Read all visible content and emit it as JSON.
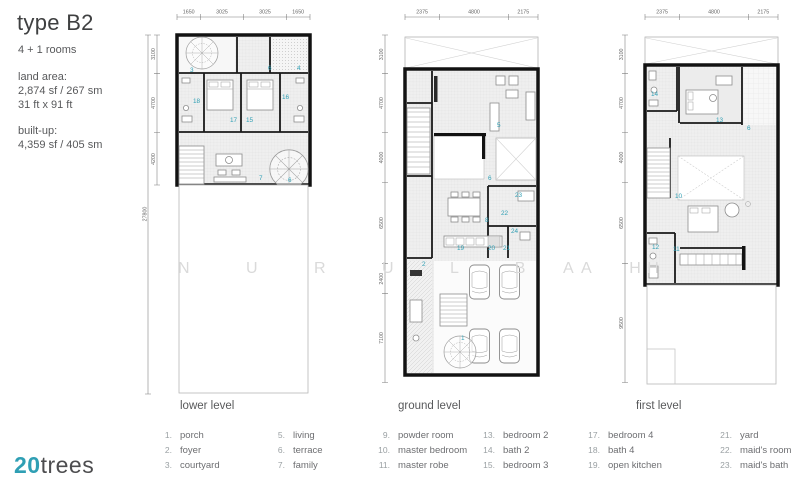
{
  "header": {
    "title": "type B2",
    "rooms": "4 + 1 rooms",
    "land_area_label": "land area:",
    "land_area_value": "2,874 sf / 267 sm",
    "land_area_dims": "31 ft x 91 ft",
    "built_up_label": "built-up:",
    "built_up_value": "4,359 sf / 405 sm"
  },
  "logo": {
    "number": "20",
    "word": "trees"
  },
  "watermark": {
    "part1": "N U R U L B A H",
    "part2": "A H"
  },
  "colors": {
    "accent_teal": "#2f9fb4",
    "wall_black": "#121212",
    "text_dark": "#3f4041",
    "text_gray": "#58595b"
  },
  "plans": [
    {
      "name": "lower level",
      "top_dims": [
        "1650",
        "3025",
        "3025",
        "1650"
      ],
      "left_dims": [
        "3100",
        "4700",
        "4200"
      ],
      "total_dim": "27800",
      "room_labels": [
        "3",
        "6",
        "4",
        "18",
        "16",
        "17",
        "15",
        "7",
        "6"
      ]
    },
    {
      "name": "ground level",
      "top_dims": [
        "2375",
        "4800",
        "2175"
      ],
      "left_dims": [
        "3100",
        "4700",
        "4000",
        "6500",
        "2400",
        "7100"
      ],
      "room_labels": [
        "5",
        "6",
        "23",
        "22",
        "8",
        "24",
        "19",
        "20",
        "21",
        "2",
        "1"
      ]
    },
    {
      "name": "first level",
      "top_dims": [
        "2375",
        "4800",
        "2175"
      ],
      "left_dims": [
        "3100",
        "4700",
        "4000",
        "6500",
        "9500"
      ],
      "room_labels": [
        "14",
        "13",
        "6",
        "10",
        "12",
        "11"
      ]
    }
  ],
  "legends": [
    {
      "title": "lower level",
      "col1": [
        {
          "num": "1.",
          "label": "porch"
        },
        {
          "num": "2.",
          "label": "foyer"
        },
        {
          "num": "3.",
          "label": "courtyard"
        }
      ],
      "col2": [
        {
          "num": "5.",
          "label": "living"
        },
        {
          "num": "6.",
          "label": "terrace"
        },
        {
          "num": "7.",
          "label": "family"
        }
      ]
    },
    {
      "title": "ground level",
      "col1": [
        {
          "num": "9.",
          "label": "powder room"
        },
        {
          "num": "10.",
          "label": "master bedroom"
        },
        {
          "num": "11.",
          "label": "master robe"
        }
      ],
      "col2": [
        {
          "num": "13.",
          "label": "bedroom 2"
        },
        {
          "num": "14.",
          "label": "bath 2"
        },
        {
          "num": "15.",
          "label": "bedroom 3"
        }
      ]
    },
    {
      "title": "first level",
      "col1": [
        {
          "num": "17.",
          "label": "bedroom 4"
        },
        {
          "num": "18.",
          "label": "bath 4"
        },
        {
          "num": "19.",
          "label": "open kitchen"
        }
      ],
      "col2": [
        {
          "num": "21.",
          "label": "yard"
        },
        {
          "num": "22.",
          "label": "maid's room"
        },
        {
          "num": "23.",
          "label": "maid's bath"
        }
      ]
    }
  ]
}
